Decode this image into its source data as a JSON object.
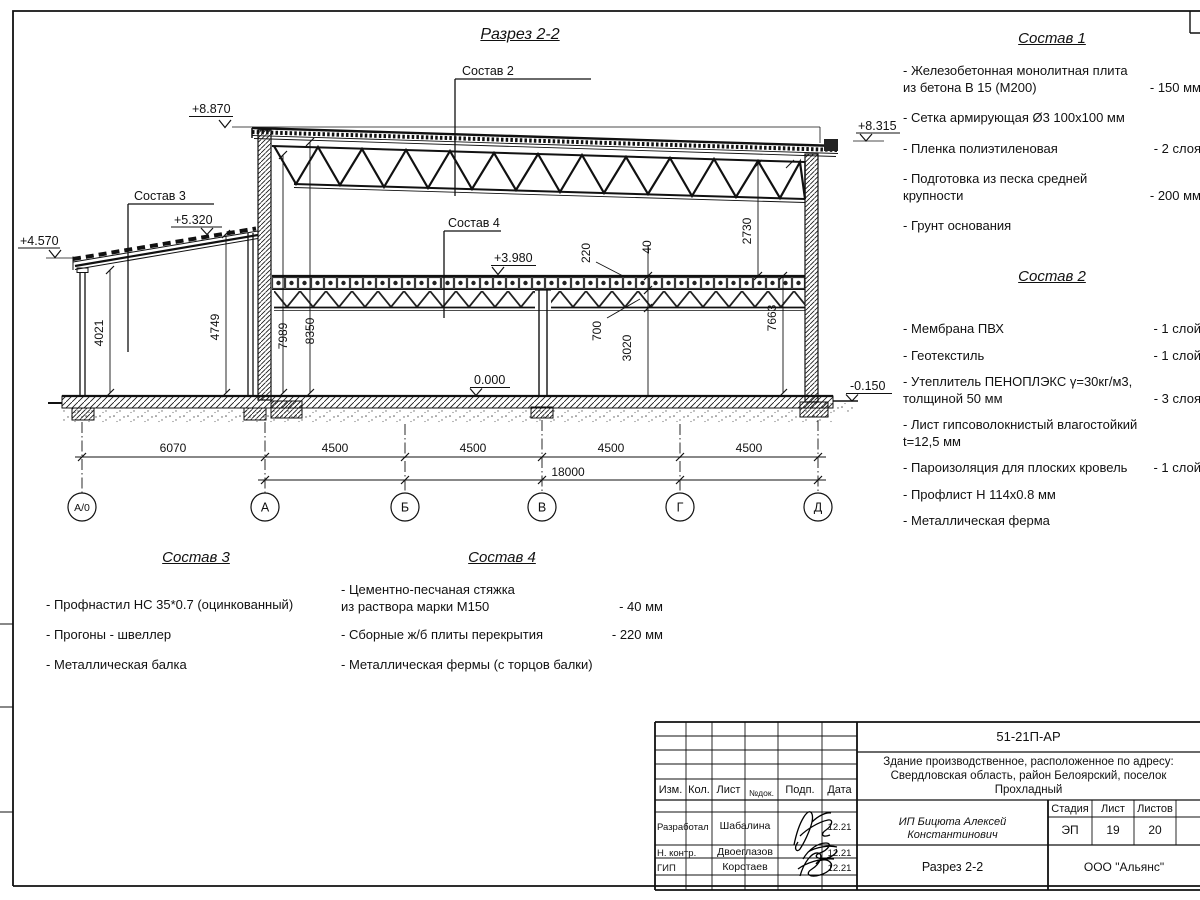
{
  "sheet": {
    "title": "Разрез 2-2"
  },
  "drawing": {
    "elev": {
      "p8870": "+8.870",
      "p8315": "+8.315",
      "p5320": "+5.320",
      "p4570": "+4.570",
      "p3980": "+3.980",
      "zero": "0.000",
      "m0150": "-0.150"
    },
    "leader": {
      "s2": "Состав 2",
      "s3": "Состав 3",
      "s4": "Состав 4"
    },
    "dim": {
      "d4021": "4021",
      "d4749": "4749",
      "d7989": "7989",
      "d8350": "8350",
      "d220": "220",
      "d40": "40",
      "d700": "700",
      "d3020": "3020",
      "d2730": "2730",
      "d7663": "7663",
      "d6070": "6070",
      "d4500": "4500",
      "d18000": "18000"
    },
    "axes": [
      "А/0",
      "А",
      "Б",
      "В",
      "Г",
      "Д"
    ]
  },
  "lists": {
    "s1": {
      "title": "Состав 1",
      "items": [
        {
          "name": "- Железобетонная  монолитная плита\nиз бетона В 15 (М200)",
          "value": "- 150 мм"
        },
        {
          "name": "- Сетка армирующая Ø3 100х100 мм",
          "value": ""
        },
        {
          "name": "- Пленка полиэтиленовая",
          "value": "- 2 слоя"
        },
        {
          "name": "- Подготовка из песка средней\nкрупности",
          "value": "- 200 мм"
        },
        {
          "name": "- Грунт основания",
          "value": ""
        }
      ]
    },
    "s2": {
      "title": "Состав 2",
      "items": [
        {
          "name": "- Мембрана ПВХ",
          "value": "- 1 слой"
        },
        {
          "name": "- Геотекстиль",
          "value": "- 1 слой"
        },
        {
          "name": "- Утеплитель ПЕНОПЛЭКС γ=30кг/м3,\nтолщиной 50 мм",
          "value": "- 3 слоя"
        },
        {
          "name": "- Лист гипсоволокнистый влагостойкий\nt=12,5 мм",
          "value": ""
        },
        {
          "name": "- Пароизоляция для плоских кровель",
          "value": "- 1 слой"
        },
        {
          "name": "- Профлист Н 114х0.8 мм",
          "value": ""
        },
        {
          "name": "- Металлическая ферма",
          "value": ""
        }
      ]
    },
    "s3": {
      "title": "Состав 3",
      "items": [
        {
          "name": "- Профнастил НС 35*0.7 (оцинкованный)",
          "value": ""
        },
        {
          "name": "- Прогоны - швеллер",
          "value": ""
        },
        {
          "name": "- Металлическая балка",
          "value": ""
        }
      ]
    },
    "s4": {
      "title": "Состав 4",
      "items": [
        {
          "name": "- Цементно-песчаная стяжка\nиз раствора марки М150",
          "value": "- 40 мм"
        },
        {
          "name": "- Сборные ж/б плиты перекрытия",
          "value": "- 220 мм"
        },
        {
          "name": "- Металлическая фермы (с торцов балки)",
          "value": ""
        }
      ]
    }
  },
  "titleblock": {
    "doc_number": "51-21П-АР",
    "desc1": "Здание производственное, расположенное по адресу:",
    "desc2": "Свердловская область, район Белоярский, поселок",
    "desc3": "Прохладный",
    "cols": {
      "izm": "Изм.",
      "kol": "Кол.",
      "list": "Лист",
      "ndok": "№док.",
      "podp": "Подп.",
      "data": "Дата"
    },
    "rows": [
      {
        "role": "Разработал",
        "name": "Шабалина",
        "date": "12.21"
      },
      {
        "role": "Н. контр.",
        "name": "Двоеглазов",
        "date": "12.21"
      },
      {
        "role": "ГИП",
        "name": "Коротаев",
        "date": "12.21"
      }
    ],
    "customer": "ИП Бицюта Алексей Константинович",
    "stage_label": "Стадия",
    "sheet_label": "Лист",
    "sheets_label": "Листов",
    "stage": "ЭП",
    "sheet": "19",
    "sheets": "20",
    "sheet_title": "Разрез 2-2",
    "org": "ООО \"Альянс\""
  }
}
